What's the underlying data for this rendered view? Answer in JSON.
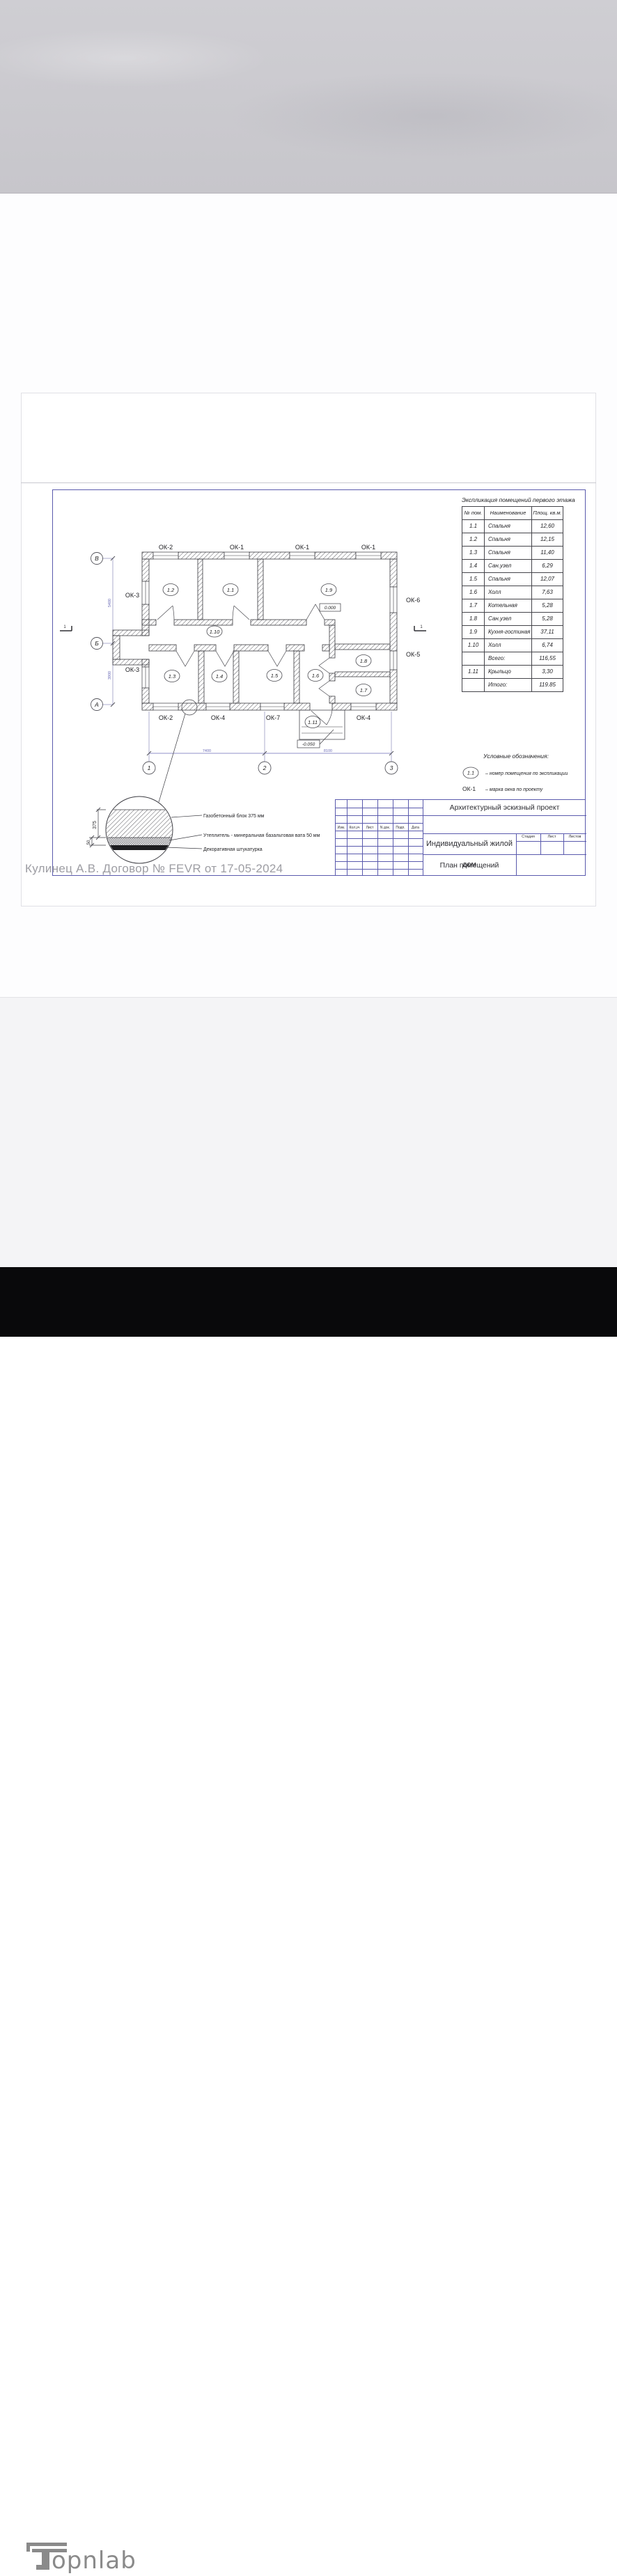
{
  "expl_table": {
    "title": "Экспликация помещений первого этажа",
    "headers": [
      "№ пом.",
      "Наименование",
      "Площ. кв.м."
    ],
    "rows": [
      [
        "1.1",
        "Спальня",
        "12,60"
      ],
      [
        "1.2",
        "Спальня",
        "12,15"
      ],
      [
        "1.3",
        "Спальня",
        "11,40"
      ],
      [
        "1.4",
        "Сан.узел",
        "6,29"
      ],
      [
        "1.5",
        "Спальня",
        "12,07"
      ],
      [
        "1.6",
        "Холл",
        "7,63"
      ],
      [
        "1.7",
        "Котельная",
        "5,28"
      ],
      [
        "1.8",
        "Сан.узел",
        "5,28"
      ],
      [
        "1.9",
        "Кухня-гостиная",
        "37,11"
      ],
      [
        "1.10",
        "Холл",
        "6,74"
      ],
      [
        "",
        "Всего:",
        "116,55"
      ],
      [
        "1.11",
        "Крыльцо",
        "3,30"
      ],
      [
        "",
        "Итого:",
        "119.85"
      ]
    ]
  },
  "plan": {
    "axis_letters": [
      "В",
      "Б",
      "А"
    ],
    "axis_numbers": [
      "1",
      "2",
      "3"
    ],
    "windows_top": [
      "ОК-2",
      "ОК-1",
      "ОК-1",
      "ОК-1"
    ],
    "windows_bottom": [
      "ОК-2",
      "ОК-4",
      "ОК-7",
      "ОК-4"
    ],
    "windows_left": [
      "ОК-3",
      "ОК-3"
    ],
    "windows_right": [
      "ОК-6",
      "ОК-5"
    ],
    "rooms": {
      "r1_1": "1.1",
      "r1_2": "1.2",
      "r1_3": "1.3",
      "r1_4": "1.4",
      "r1_5": "1.5",
      "r1_6": "1.6",
      "r1_7": "1.7",
      "r1_8": "1.8",
      "r1_9": "1.9",
      "r1_10": "1.10",
      "r1_11": "1.11"
    },
    "elevations": {
      "zero": "0.000",
      "porch": "-0.050"
    },
    "dims": {
      "left_upper": "5400",
      "left_lower": "3900",
      "bottom_left": "7400",
      "bottom_right": "8100"
    },
    "section_mark": "1"
  },
  "legend": {
    "title": "Условные обозначения:",
    "room_symbol": "1.1",
    "room_text": "– номер помещения по экспликации",
    "window_symbol": "ОК-1",
    "window_text": "– марка окна по проекту"
  },
  "detail": {
    "labels": [
      "Газобетонный блок 375 мм",
      "Утеплитель - минеральная базальтовая вата 50 мм",
      "Декоративная штукатурка"
    ],
    "dims": [
      "375",
      "50"
    ]
  },
  "title_block": {
    "project": "Архитектурный эскизный проект",
    "object": "Индивидуальный жилой дом",
    "drawing": "План помещений",
    "columns": [
      "Изм.",
      "Кол.уч",
      "Лист",
      "N док.",
      "Подп.",
      "Дата"
    ],
    "stage_cols": [
      "Стадия",
      "Лист",
      "Листов"
    ]
  },
  "contract_note": "Кулинец А.В. Договор № FEVR от 17-05-2024",
  "watermark": {
    "brand": "Topnlab",
    "logo_text": "opnlab"
  }
}
